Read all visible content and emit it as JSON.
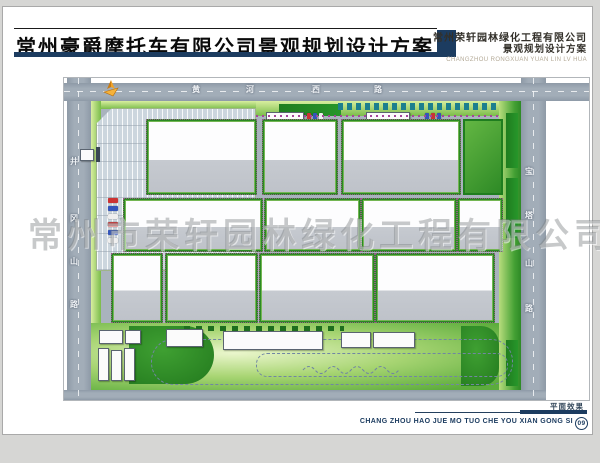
{
  "header": {
    "title": "常州豪爵摩托车有限公司景观规划设计方案",
    "company": "常州荣轩园林绿化工程有限公司",
    "subtitle": "景观规划设计方案",
    "company_pinyin": "CHANGZHOU RONGXUAN YUAN LIN LV HUA"
  },
  "watermark": "常州市荣轩园林绿化工程有限公司",
  "plan": {
    "road_north": {
      "name": "黄河西路",
      "chars": [
        "黄",
        "河",
        "西",
        "路"
      ]
    },
    "road_west": {
      "name": "井冈山路",
      "chars": [
        "井",
        "冈",
        "山",
        "路"
      ]
    },
    "road_east": {
      "name": "宝塔山路",
      "chars": [
        "宝",
        "塔",
        "山",
        "路"
      ]
    },
    "compass_icon": "north-arrow"
  },
  "footer": {
    "caption": "平面效果",
    "pinyin": "CHANG ZHOU HAO JUE MO TUO CHE YOU XIAN GONG SI",
    "page_number": "09"
  },
  "colors": {
    "accent_navy": "#1c3c60",
    "road_gray": "#9aa5b1",
    "hedge_green": "#1f7d1f",
    "verge_green": "#8cc45e",
    "building_gray": "#c6cad0"
  }
}
